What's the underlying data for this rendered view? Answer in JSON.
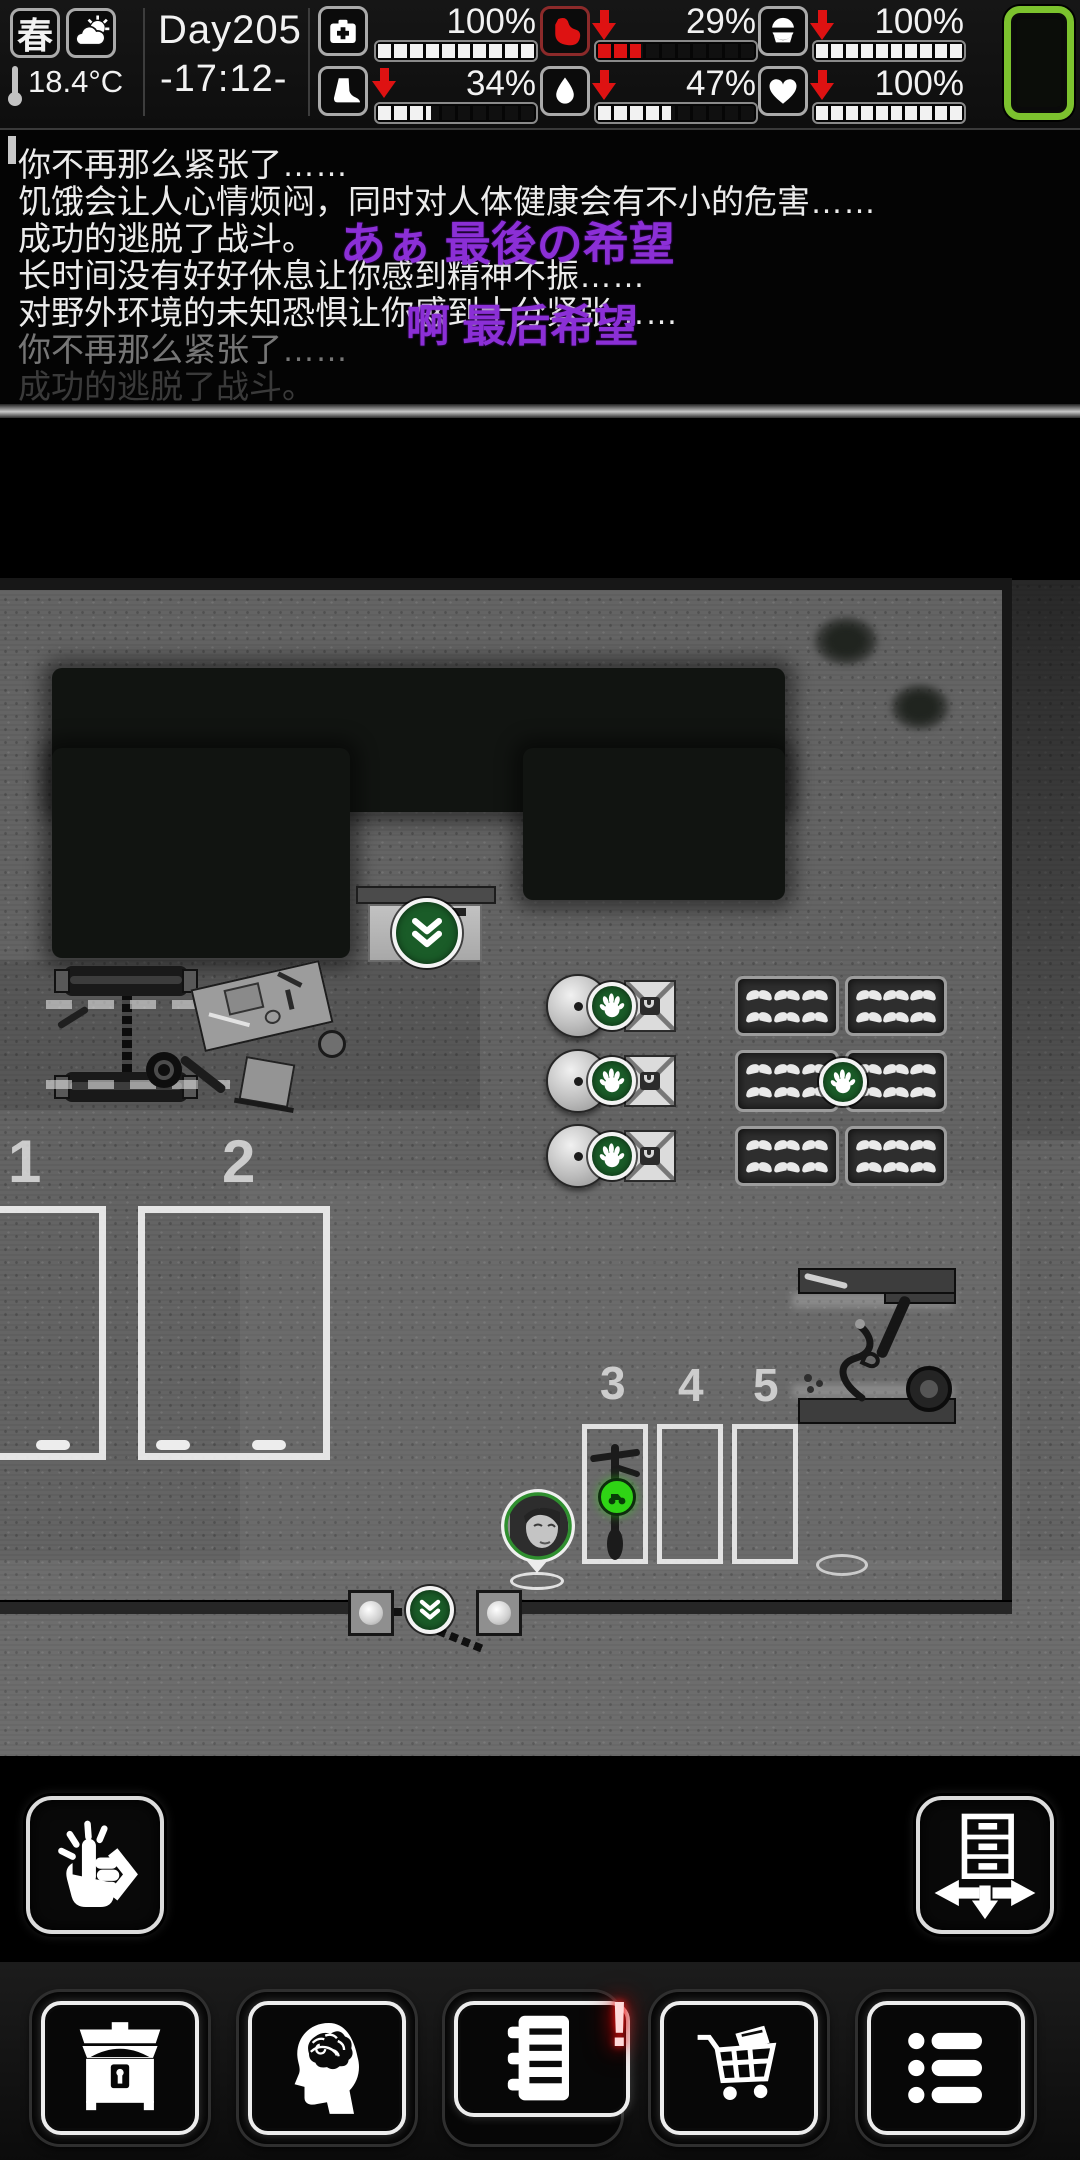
{
  "status_bar": {
    "season": "春",
    "weather": "sun-behind-clouds",
    "temperature": "18.4°C",
    "day": "Day205",
    "time": "-17:12-",
    "stats": [
      {
        "name": "health",
        "icon": "first-aid-kit-icon",
        "value": "100%",
        "percent": 100,
        "trend": "",
        "bar_color": "#f2f2f2"
      },
      {
        "name": "stamina",
        "icon": "boot-icon",
        "value": "34%",
        "percent": 34,
        "trend": "down",
        "bar_color": "#f2f2f2"
      },
      {
        "name": "hunger",
        "icon": "stomach-icon",
        "value": "29%",
        "percent": 29,
        "trend": "down",
        "bar_color": "#de1212"
      },
      {
        "name": "thirst",
        "icon": "water-drop-icon",
        "value": "47%",
        "percent": 47,
        "trend": "down",
        "bar_color": "#f2f2f2"
      },
      {
        "name": "sanity",
        "icon": "head-icon",
        "value": "100%",
        "percent": 100,
        "trend": "down",
        "bar_color": "#f2f2f2"
      },
      {
        "name": "mood",
        "icon": "heart-icon",
        "value": "100%",
        "percent": 100,
        "trend": "down",
        "bar_color": "#f2f2f2"
      }
    ]
  },
  "message_log": {
    "lines": [
      {
        "text": "你不再那么紧张了……"
      },
      {
        "text": "饥饿会让人心情烦闷，同时对人体健康会有不小的危害……"
      },
      {
        "text": "成功的逃脱了战斗。"
      },
      {
        "text": "长时间没有好好休息让你感到精神不振……"
      },
      {
        "text": "对野外环境的未知恐惧让你感到十分紧张……"
      },
      {
        "text": "你不再那么紧张了……"
      },
      {
        "text": "成功的逃脱了战斗。"
      }
    ],
    "floating": [
      "あぁ 最後の希望",
      "啊 最后希望"
    ]
  },
  "map": {
    "floor_numbers": [
      "1",
      "2",
      "3",
      "4",
      "5"
    ],
    "markers": [
      "descend-door",
      "operate-machine",
      "operate-machine",
      "operate-machine",
      "harvest-tray",
      "ride-vehicle",
      "open-gate"
    ]
  },
  "toolbar": {
    "journal_alert": "!",
    "buttons": [
      "storage-chest",
      "character-mind",
      "journal",
      "trade-cart",
      "task-list"
    ]
  },
  "action_buttons": {
    "left": "tap-to-interact",
    "right": "move-furniture"
  },
  "colors": {
    "accent_green_dark": "#1a5c28",
    "accent_green_bright": "#2fd415",
    "device_green": "#7cc22e",
    "alert_red": "#de1212",
    "floating_purple": "#8b2fd6"
  }
}
